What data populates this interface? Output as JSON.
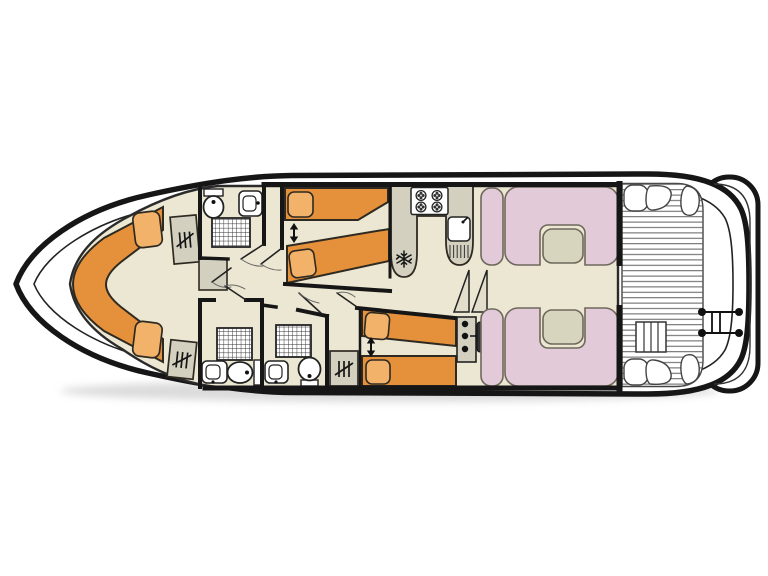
{
  "image_type": "boat-deck-floor-plan",
  "orientation": "bow-left-stern-right",
  "colors": {
    "background": "#FFFFFF",
    "floor": "#ECE7D2",
    "bed": "#E5913B",
    "pillow": "#F2B269",
    "furniture": "#D3D0BF",
    "cabinet": "#D3D0BF",
    "seat": "#E2CAD8",
    "table": "#D8D5BF",
    "stair": "#E2DECB",
    "fixture_white": "#FFFFFF",
    "wall": "#161616",
    "outline": "#2E2A22",
    "seat_outline": "#6E685C",
    "deck_line": "#5F5F5F",
    "shadow": "#9A9A9A"
  },
  "areas": {
    "bow_cabin": {
      "bed_type": "v-berth-double",
      "pillows": 2,
      "wardrobes": 2
    },
    "forward_bathroom": {
      "toilet": 1,
      "washbasin": 1,
      "shower": 1,
      "cabinet": 1
    },
    "port_mid_cabin": {
      "single_beds": 2,
      "pillows": 2,
      "slide_together_arrow": true
    },
    "mid_bathroom_1": {
      "shower": 1,
      "washbasin": 1,
      "toilet": 1
    },
    "mid_bathroom_2": {
      "shower": 1,
      "washbasin": 1,
      "toilet": 1
    },
    "aft_starboard_cabin": {
      "single_beds": 2,
      "pillows": 2,
      "slide_together_arrow": true,
      "wardrobe": 1
    },
    "galley": {
      "stove_burners": 4,
      "sink_with_drainer": 1,
      "fridge_snowflake": 1
    },
    "stairs_steps": 2,
    "helm": {
      "instrument_dots": 3,
      "steering_wheel": 1
    },
    "saloon": {
      "u_dinettes": 2,
      "tables": 2,
      "side_seats": 2
    },
    "aft_deck": {
      "planked": true,
      "corner_seats": 4,
      "deck_ladder": 1
    },
    "stern_platform": {
      "rail_posts": 4,
      "swim_ladder_rungs": 2
    }
  }
}
